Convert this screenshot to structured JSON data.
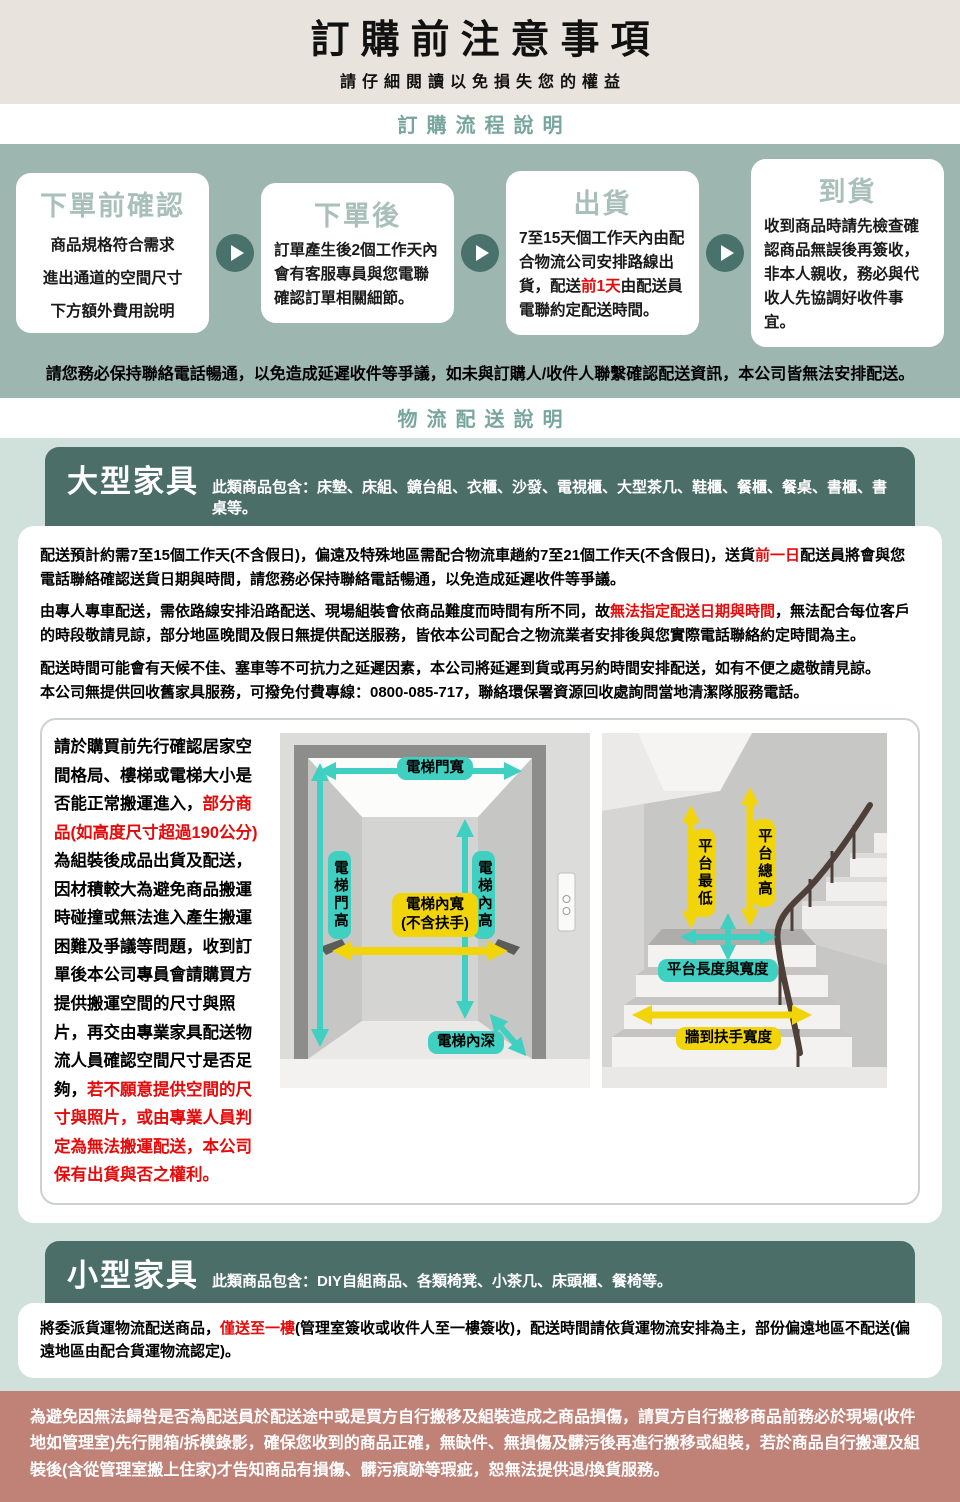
{
  "header": {
    "title": "訂購前注意事項",
    "subtitle": "請仔細閱讀以免損失您的權益"
  },
  "sections": {
    "flow_heading": "訂購流程說明",
    "logistics_heading": "物流配送說明"
  },
  "flow": {
    "steps": [
      {
        "title": "下單前確認",
        "lines": [
          "商品規格符合需求",
          "進出通道的空間尺寸",
          "下方額外費用說明"
        ]
      },
      {
        "title": "下單後",
        "segments": [
          {
            "text": "訂單產生後2個工作天內會有客服專員與您電聯確認訂單相關細節。"
          }
        ]
      },
      {
        "title": "出貨",
        "segments": [
          {
            "text": "7至15天個工作天內由配合物流公司安排路線出貨，配送"
          },
          {
            "text": "前1天",
            "red": true
          },
          {
            "text": "由配送員電聯約定配送時間。"
          }
        ]
      },
      {
        "title": "到貨",
        "segments": [
          {
            "text": "收到商品時請先檢查確認商品無誤後再簽收，非本人親收，務必與代收人先協調好收件事宜。"
          }
        ]
      }
    ],
    "note": "請您務必保持聯絡電話暢通，以免造成延遲收件等爭議，如未與訂購人/收件人聯繫確認配送資訊，本公司皆無法安排配送。"
  },
  "large": {
    "title": "大型家具",
    "desc": "此類商品包含：床墊、床組、鏡台組、衣櫃、沙發、電視櫃、大型茶几、鞋櫃、餐櫃、餐桌、書櫃、書桌等。",
    "para1": [
      {
        "text": "配送預計約需7至15個工作天(不含假日)，偏遠及特殊地區需配合物流車趟約7至21個工作天(不含假日)，送貨"
      },
      {
        "text": "前一日",
        "red": true
      },
      {
        "text": "配送員將會與您電話聯絡確認送貨日期與時間，請您務必保持聯絡電話暢通，以免造成延遲收件等爭議。"
      }
    ],
    "para2": [
      {
        "text": "由專人專車配送，需依路線安排沿路配送、現場組裝會依商品難度而時間有所不同，故"
      },
      {
        "text": "無法指定配送日期與時間",
        "red": true
      },
      {
        "text": "，無法配合每位客戶的時段敬請見諒，部分地區晚間及假日無提供配送服務，皆依本公司配合之物流業者安排後與您實際電話聯絡約定時間為主。"
      }
    ],
    "para3a": [
      {
        "text": "配送時間可能會有天候不佳、塞車等不可抗力之延遲因素，本公司將延遲到貨或再另約時間安排配送，如有不便之處敬請見諒。"
      }
    ],
    "para3b": [
      {
        "text": "本公司無提供回收舊家具服務，可撥免付費專線：0800-085-717，聯絡環保署資源回收處詢問當地清潔隊服務電話。"
      }
    ],
    "space_note": [
      {
        "text": "請於購買前先行確認居家空間格局、樓梯或電梯大小是否能正常搬運進入，"
      },
      {
        "text": "部分商品(如高度尺寸超過190公分)",
        "red": true
      },
      {
        "text": "為組裝後成品出貨及配送，因材積較大為避免商品搬運時碰撞或無法進入產生搬運困難及爭議等問題，收到訂單後本公司專員會請購買方提供搬運空間的尺寸與照片，再交由專業家具配送物流人員確認空間尺寸是否足夠，"
      },
      {
        "text": "若不願意提供空間的尺寸與照片，或由專業人員判定為無法搬運配送，本公司保有出貨與否之權利。",
        "red": true
      }
    ],
    "elevator_labels": {
      "door_width": "電梯門寬",
      "door_height": "電梯門高",
      "inner_height": "電梯內高",
      "inner_width": "電梯內寬",
      "inner_width_sub": "(不含扶手)",
      "inner_depth": "電梯內深"
    },
    "stair_labels": {
      "platform_min": "平台最低",
      "platform_total": "平台總高",
      "platform_lw": "平台長度與寬度",
      "wall_rail": "牆到扶手寬度"
    }
  },
  "small": {
    "title": "小型家具",
    "desc": "此類商品包含：DIY自組商品、各類椅凳、小茶几、床頭櫃、餐椅等。",
    "para": [
      {
        "text": "將委派貨運物流配送商品，"
      },
      {
        "text": "僅送至一樓",
        "red": true
      },
      {
        "text": "(管理室簽收或收件人至一樓簽收)，配送時間請依貨運物流安排為主，部份偏遠地區不配送(偏遠地區由配合貨運物流認定)。"
      }
    ]
  },
  "footer": {
    "warning": "為避免因無法歸咎是否為配送員於配送途中或是買方自行搬移及組裝造成之商品損傷，請買方自行搬移商品前務必於現場(收件地如管理室)先行開箱/拆模錄影，確保您收到的商品正確，無缺件、無損傷及髒污後再進行搬移或組裝，若於商品自行搬運及組裝後(含從管理室搬上住家)才告知商品有損傷、髒污痕跡等瑕疵，恕無法提供退/換貨服務。"
  },
  "colors": {
    "header_bg": "#e8e4dd",
    "heading_teal": "#78a69e",
    "flow_bg": "#9eb6b0",
    "step_title": "#a9bfba",
    "arrow_circle": "#48726b",
    "category_bg": "#4c6e68",
    "mint_bg": "#d0e0da",
    "arrow_teal": "#3fd0c2",
    "arrow_yellow": "#f2d40a",
    "alert_red": "#e60b0b",
    "warning_bg": "#c08177"
  }
}
